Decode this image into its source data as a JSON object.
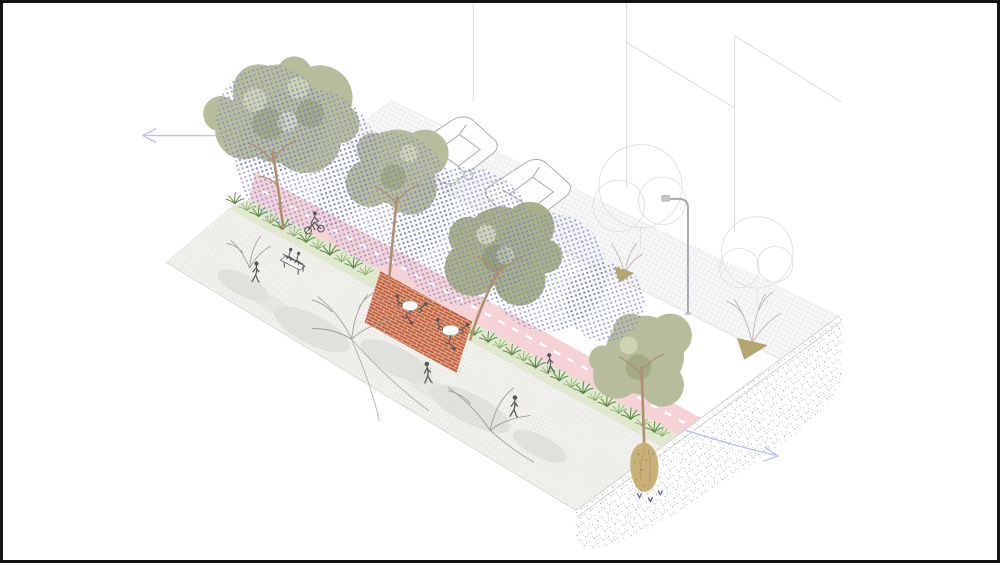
{
  "page": {
    "background": "#ffffff",
    "frame_border": "#141414"
  },
  "colors": {
    "paper": "#ffffff",
    "frame": "#141414",
    "sidewalk-base": "#f1f0ec",
    "sidewalk-dot": "#c6c5be",
    "sidewalk-cloud": "#d6d5cf",
    "hatch-base": "#f8f8f9",
    "hatch-line": "#cdcdd3",
    "shade-dot": "#7a80c4",
    "cycle-pink": "#f4d2d6",
    "lane-dash": "#ffffff",
    "grass-base": "#e0e9d0",
    "grass-dark": "#5f8a49",
    "grass-mid": "#8db06c",
    "brick": "#bf5b37",
    "brick-grout": "#edc6b1",
    "canopy": "#b7bd9c",
    "canopy-dark": "#a2ab82",
    "canopy-light": "#ced3b4",
    "canopy-olive": "#a9b088",
    "canopy-olive-dark": "#96a075",
    "trunk": "#b08e6e",
    "branch": "#a29e97",
    "far-branch": "#bab6ad",
    "leaf-pile": "#b3a76e",
    "leaf-pile-edge": "#9c8f5c",
    "car-line": "#b2b2b2",
    "person": "#54575a",
    "soil-speck": "#a3a3a1",
    "soil-edge": "#cfcfcb",
    "rootball": "#c8b176",
    "rootball-dark": "#8f7a45",
    "water": "#5055be",
    "pole": "#a7abb0",
    "building-line": "#dddddc",
    "outline-tree": "#e2e2de",
    "arrow": "#b9c1e7"
  },
  "scene": {
    "type": "axonometric-street-section-illustration",
    "description": "Axonometric cutaway illustration of a redesigned street: stippled pedestrian sidewalk with a bench and walkers, a planted rain-garden strip, a pink cycle track with dashed centerline and a cyclist, brick cafe patios with round tables, a row of street trees casting blue dotted shade over the roadway with two parked line-drawn cars, a hatched far parking strip with a street light and young bare trees with leaf piles, faint building outlines above, and a soil section cut at the lower right exposing a tree root ball with blue infiltration arrows; pale blue direction arrows point left and right.",
    "zones": [
      "near-sidewalk",
      "rain-garden-planting-strip",
      "cafe-brick-patio",
      "pink-cycle-track",
      "roadway",
      "hatched-parking-strip",
      "building-edge-outlines",
      "soil-section-cut"
    ],
    "counts": {
      "street_trees": 4,
      "parked_cars": 2,
      "cyclists": 1,
      "pedestrians": 4,
      "bench_sitters": 2,
      "cafe_tables": 2,
      "cafe_sitters": 6,
      "street_lights": 1,
      "bare_trees_near": 3,
      "bare_trees_far": 2,
      "outline_trees": 2,
      "leaf_piles": 2,
      "direction_arrows": 2,
      "infiltration_arrows": 3
    },
    "arrows": {
      "left": "flow-direction-left",
      "right": "flow-direction-right"
    }
  }
}
